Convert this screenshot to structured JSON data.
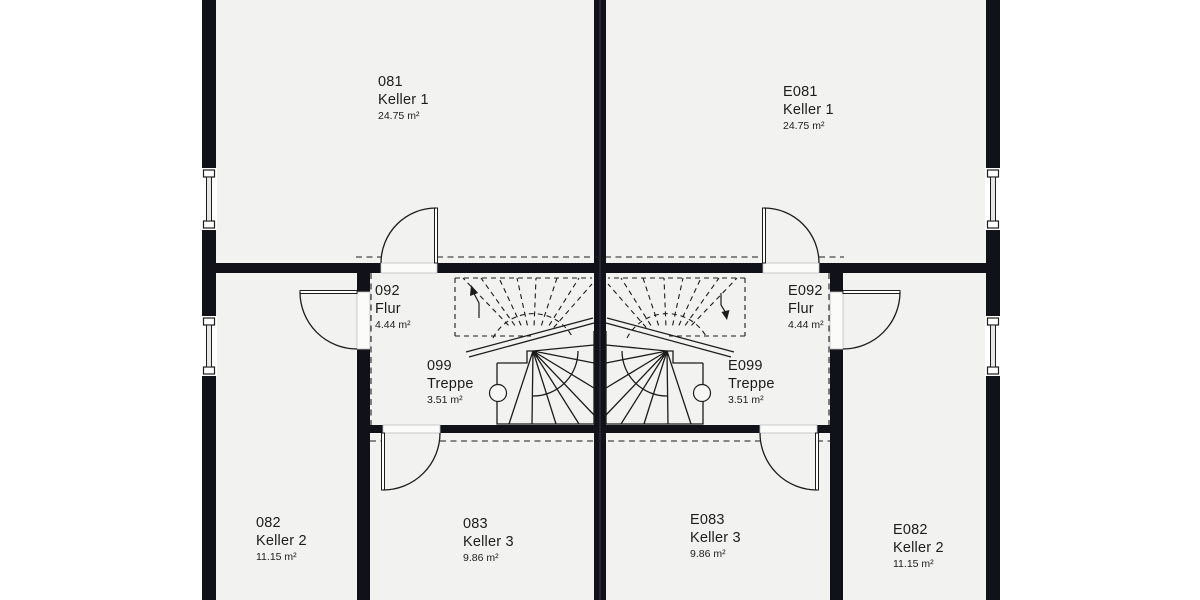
{
  "colors": {
    "wall": "#11111a",
    "floor": "#f2f2f1",
    "outside": "#ffffff",
    "line": "#1c1c1c",
    "threshold": "#fbfbfa"
  },
  "rooms": [
    {
      "id": "081",
      "name": "Keller 1",
      "area": "24.75 m²"
    },
    {
      "id": "E081",
      "name": "Keller 1",
      "area": "24.75 m²"
    },
    {
      "id": "092",
      "name": "Flur",
      "area": "4.44 m²"
    },
    {
      "id": "E092",
      "name": "Flur",
      "area": "4.44 m²"
    },
    {
      "id": "099",
      "name": "Treppe",
      "area": "3.51 m²"
    },
    {
      "id": "E099",
      "name": "Treppe",
      "area": "3.51 m²"
    },
    {
      "id": "082",
      "name": "Keller 2",
      "area": "11.15 m²"
    },
    {
      "id": "083",
      "name": "Keller 3",
      "area": "9.86 m²"
    },
    {
      "id": "E083",
      "name": "Keller 3",
      "area": "9.86 m²"
    },
    {
      "id": "E082",
      "name": "Keller 2",
      "area": "11.15 m²"
    }
  ]
}
